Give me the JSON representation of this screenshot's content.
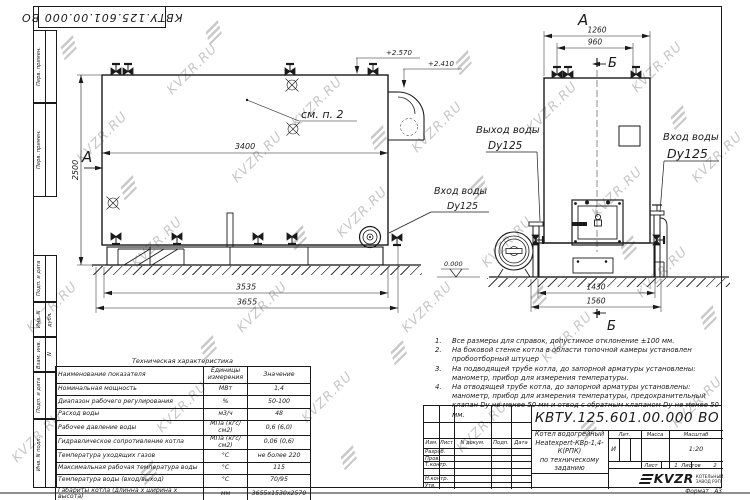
{
  "watermark": {
    "text": "KVZR.RU"
  },
  "stamp": {
    "doc_number": "КВТУ.125.601.00.000 ВО"
  },
  "side_strip": {
    "labels": [
      "Перв. примен.",
      "Перв. примен.",
      "Подп. и дата",
      "Инв. N дубл.",
      "Взам. инв. N",
      "Подп. и дата",
      "Инв. N подл."
    ]
  },
  "left_view": {
    "view_label": "А",
    "see_note": "см. п. 2",
    "dim_3400": "3400",
    "dim_2500": "2500",
    "dim_3535": "3535",
    "dim_3655": "3655",
    "elev_1": "+2.570",
    "elev_2": "+2.410",
    "inlet_1": "Вход воды",
    "inlet_2": "Dy125"
  },
  "right_view": {
    "view_label": "А",
    "section_top": "Б",
    "section_bottom": "Б",
    "dim_1260": "1260",
    "dim_960": "960",
    "dim_1430": "1430",
    "dim_1560": "1560",
    "outlet_1": "Выход воды",
    "outlet_2": "Dy125",
    "inlet_1": "Вход воды",
    "inlet_2": "Dy125",
    "level": "0.000"
  },
  "notes": [
    {
      "n": "1.",
      "t": "Все размеры для справок, допустимое отклонение ±100 мм."
    },
    {
      "n": "2.",
      "t": "На боковой стенке котла в области топочной камеры установлен пробоотборный штуцер"
    },
    {
      "n": "3.",
      "t": "На подводящей трубе котла, до запорной арматуры установлены: манометр, прибор для измерения температуры."
    },
    {
      "n": "4.",
      "t": "На отводящей трубе котла, до запорной арматуры установлены: манометр, прибор для измерения температуры, предохранительный клапан Dу не менее 50 мм и отвод с обратным клапаном Dу не менее 50 мм."
    }
  ],
  "tech_table": {
    "title": "Техническая характеристика",
    "headers": {
      "name": "Наименование показателя",
      "unit": "Единицы измерения",
      "value": "Значение"
    },
    "rows": [
      {
        "n": "Номинальная мощность",
        "u": "МВт",
        "v": "1,4"
      },
      {
        "n": "Диапазон рабочего регулирования",
        "u": "%",
        "v": "50-100"
      },
      {
        "n": "Расход воды",
        "u": "м3/ч",
        "v": "48"
      },
      {
        "n": "Рабочее давление воды",
        "u": "МПа (кгс/см2)",
        "v": "0,6 (6,0)"
      },
      {
        "n": "Гидравлическое сопротивление котла",
        "u": "МПа (кгс/см2)",
        "v": "0,06 (0,6)"
      },
      {
        "n": "Температура уходящих газов",
        "u": "°С",
        "v": "не более 220"
      },
      {
        "n": "Максимальная рабочая температура воды",
        "u": "°С",
        "v": "115"
      },
      {
        "n": "Температура воды (вход/выход)",
        "u": "°С",
        "v": "70/95"
      },
      {
        "n": "Габариты котла (длинна х ширина х высота)",
        "u": "мм",
        "v": "3655х1530х2570"
      }
    ]
  },
  "title_block": {
    "doc_number": "КВТУ.125.601.00.000 ВО",
    "product_line1": "Котел водогрейный",
    "product_line2": "Heatexpert-КВр-1,4-К(РПК)",
    "product_line3": "по техническому заданию",
    "header_cols": [
      "Изм.",
      "Лист",
      "N докум.",
      "Подп.",
      "Дата"
    ],
    "row_labels": [
      "Разраб.",
      "Пров.",
      "Т.контр.",
      "",
      "Н.контр.",
      "Утв."
    ],
    "lit_header": "Лит.",
    "mass_header": "Масса",
    "scale_header": "Масштаб",
    "lit_value": "И",
    "scale_value": "1:20",
    "sheet_label": "Лист",
    "sheet_value": "1",
    "sheets_label": "Листов",
    "sheets_value": "2",
    "logo_text": "KVZR",
    "logo_caption1": "КОТЕЛЬНЫЙ",
    "logo_caption2": "ЗАВОД РЭП",
    "format_label": "Формат",
    "format_value": "А3"
  }
}
